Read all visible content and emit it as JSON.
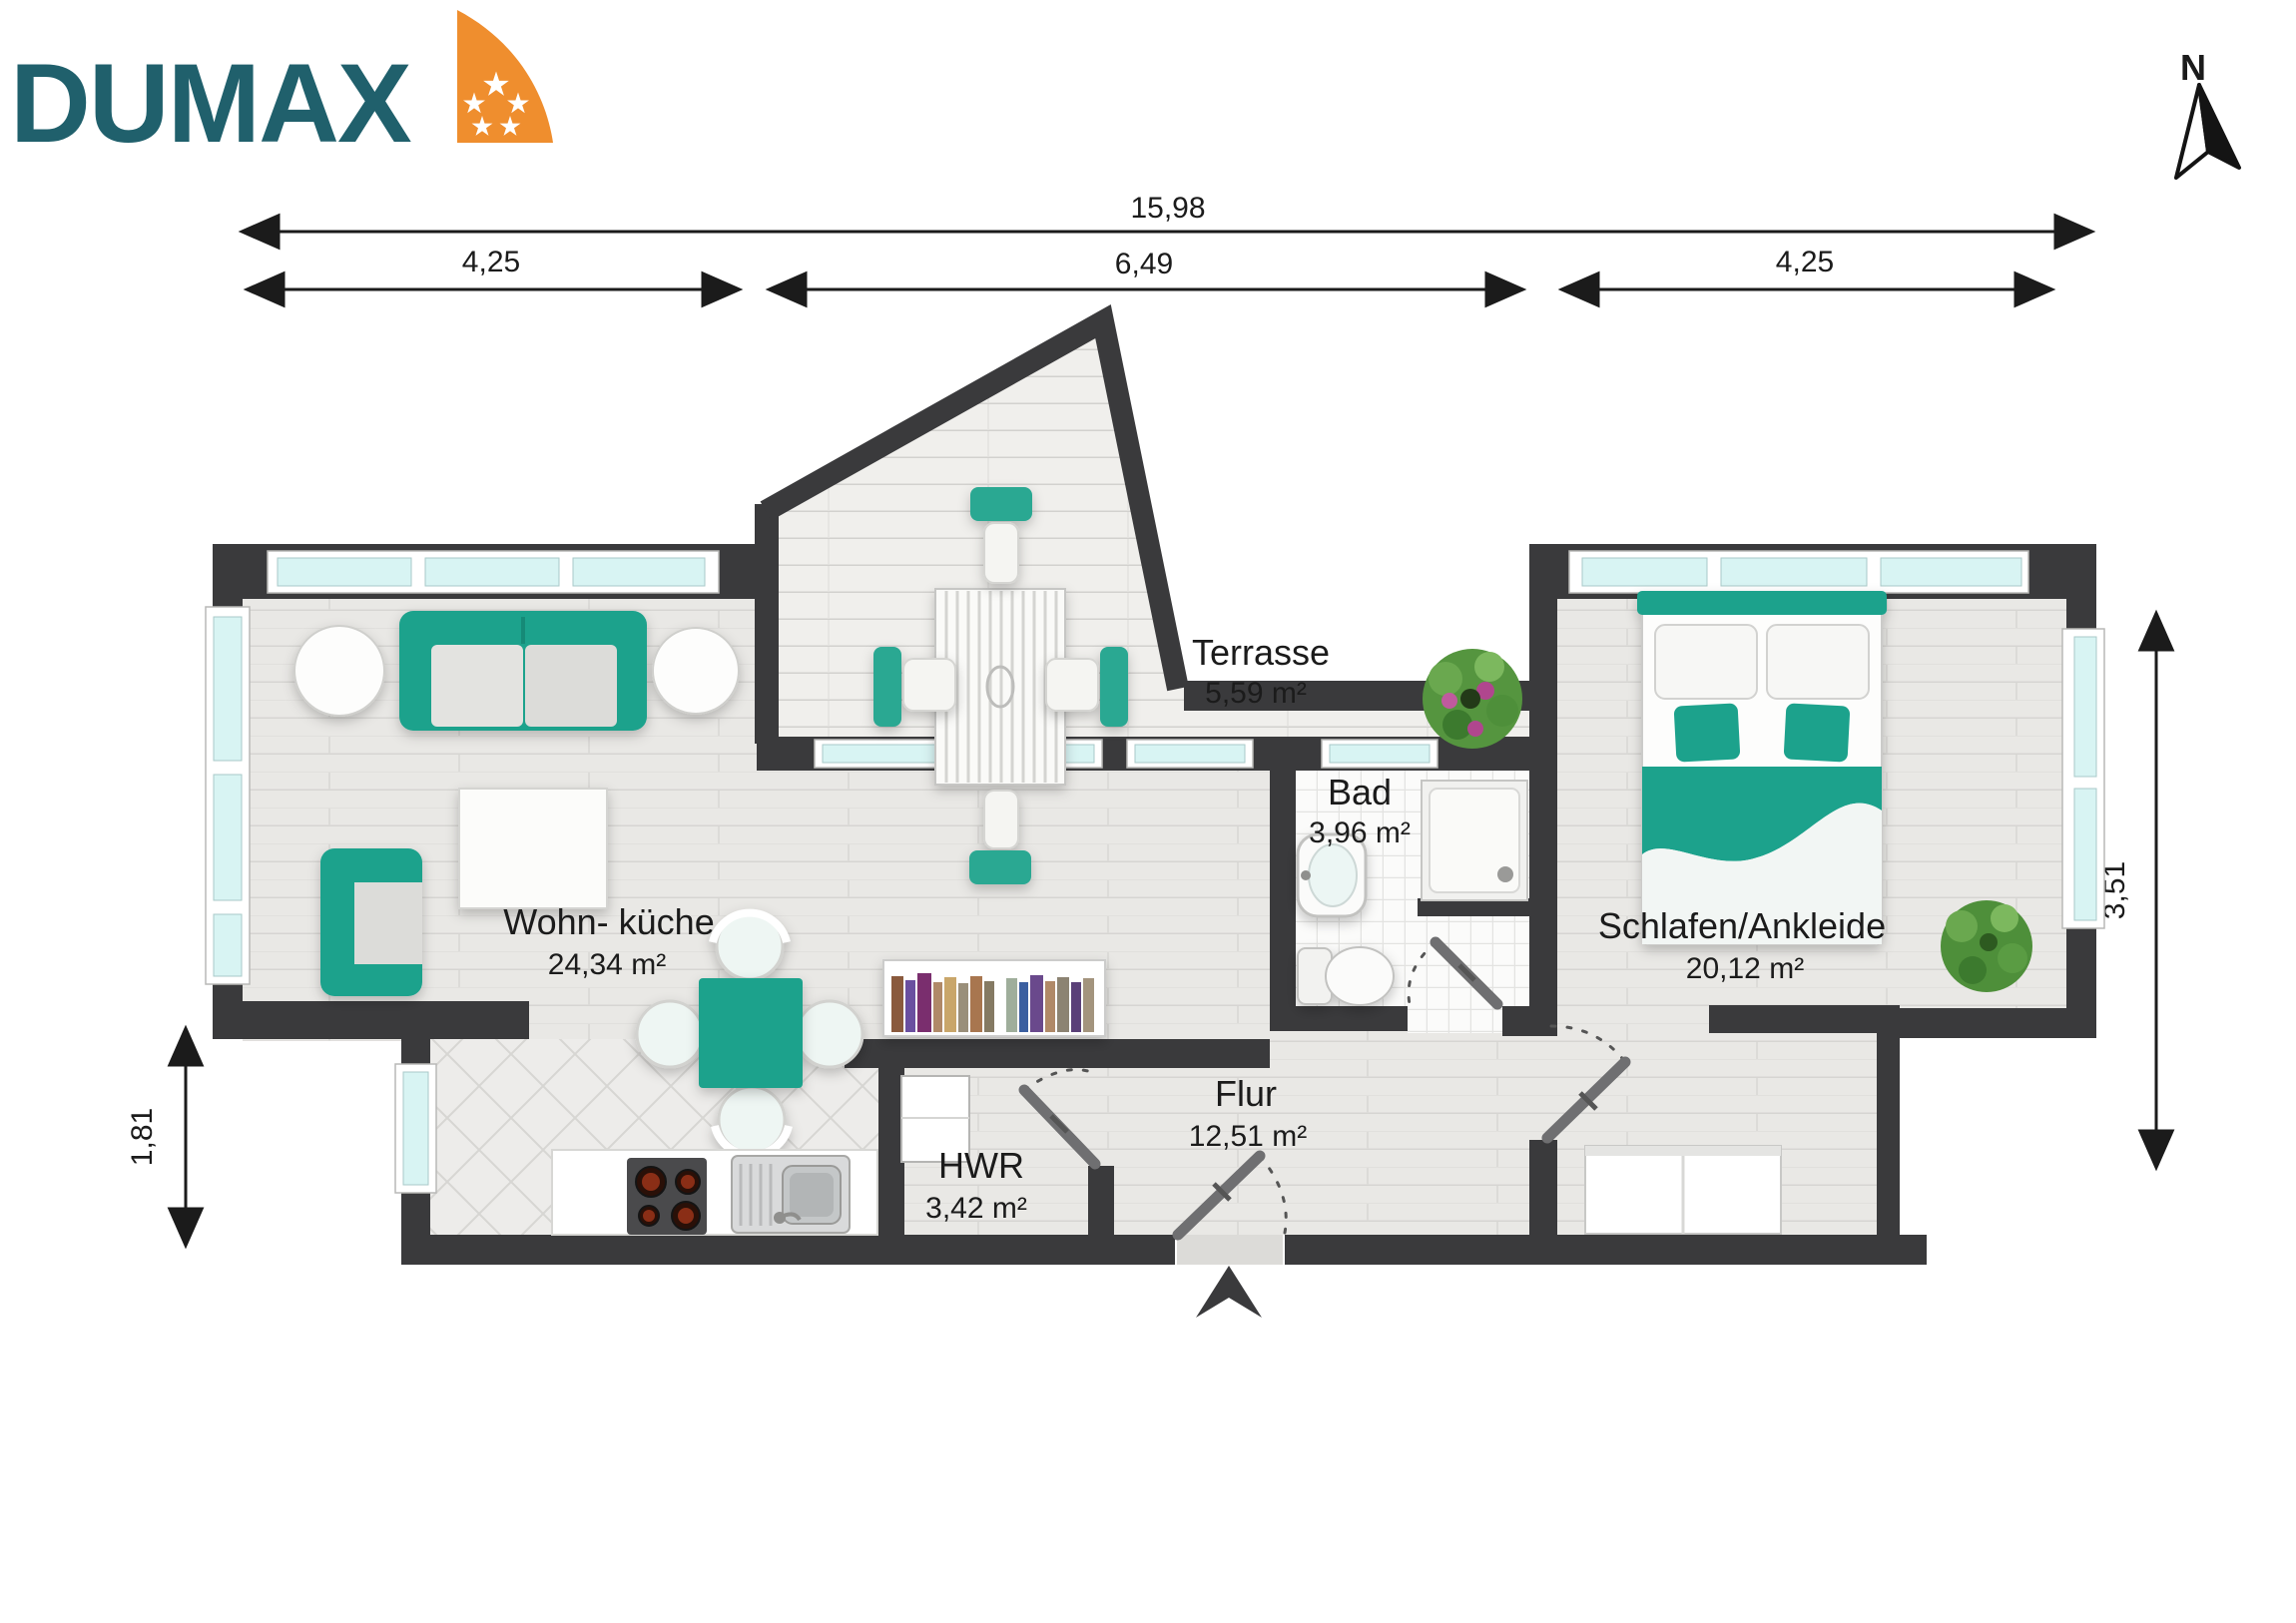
{
  "logo": {
    "text": "DUMAX"
  },
  "compass": {
    "label": "N"
  },
  "dimensions": {
    "total_width": "15,98",
    "width_left": "4,25",
    "width_middle": "6,49",
    "width_right": "4,25",
    "height_right": "3,51",
    "height_left": "1,81"
  },
  "rooms": {
    "living": {
      "name": "Wohn- küche",
      "area": "24,34 m²"
    },
    "terrace": {
      "name": "Terrasse",
      "area": "5,59 m²"
    },
    "bath": {
      "name": "Bad",
      "area": "3,96 m²"
    },
    "hall": {
      "name": "Flur",
      "area": "12,51 m²"
    },
    "utility": {
      "name": "HWR",
      "area": "3,42 m²"
    },
    "bedroom": {
      "name": "Schlafen/Ankleide",
      "area": "20,12 m²"
    }
  },
  "colors": {
    "wall": "#3a3a3c",
    "accent_teal": "#1fa28c",
    "logo_teal": "#20606c",
    "logo_orange": "#ef8e2e",
    "window_glass": "#d8f4f3"
  }
}
